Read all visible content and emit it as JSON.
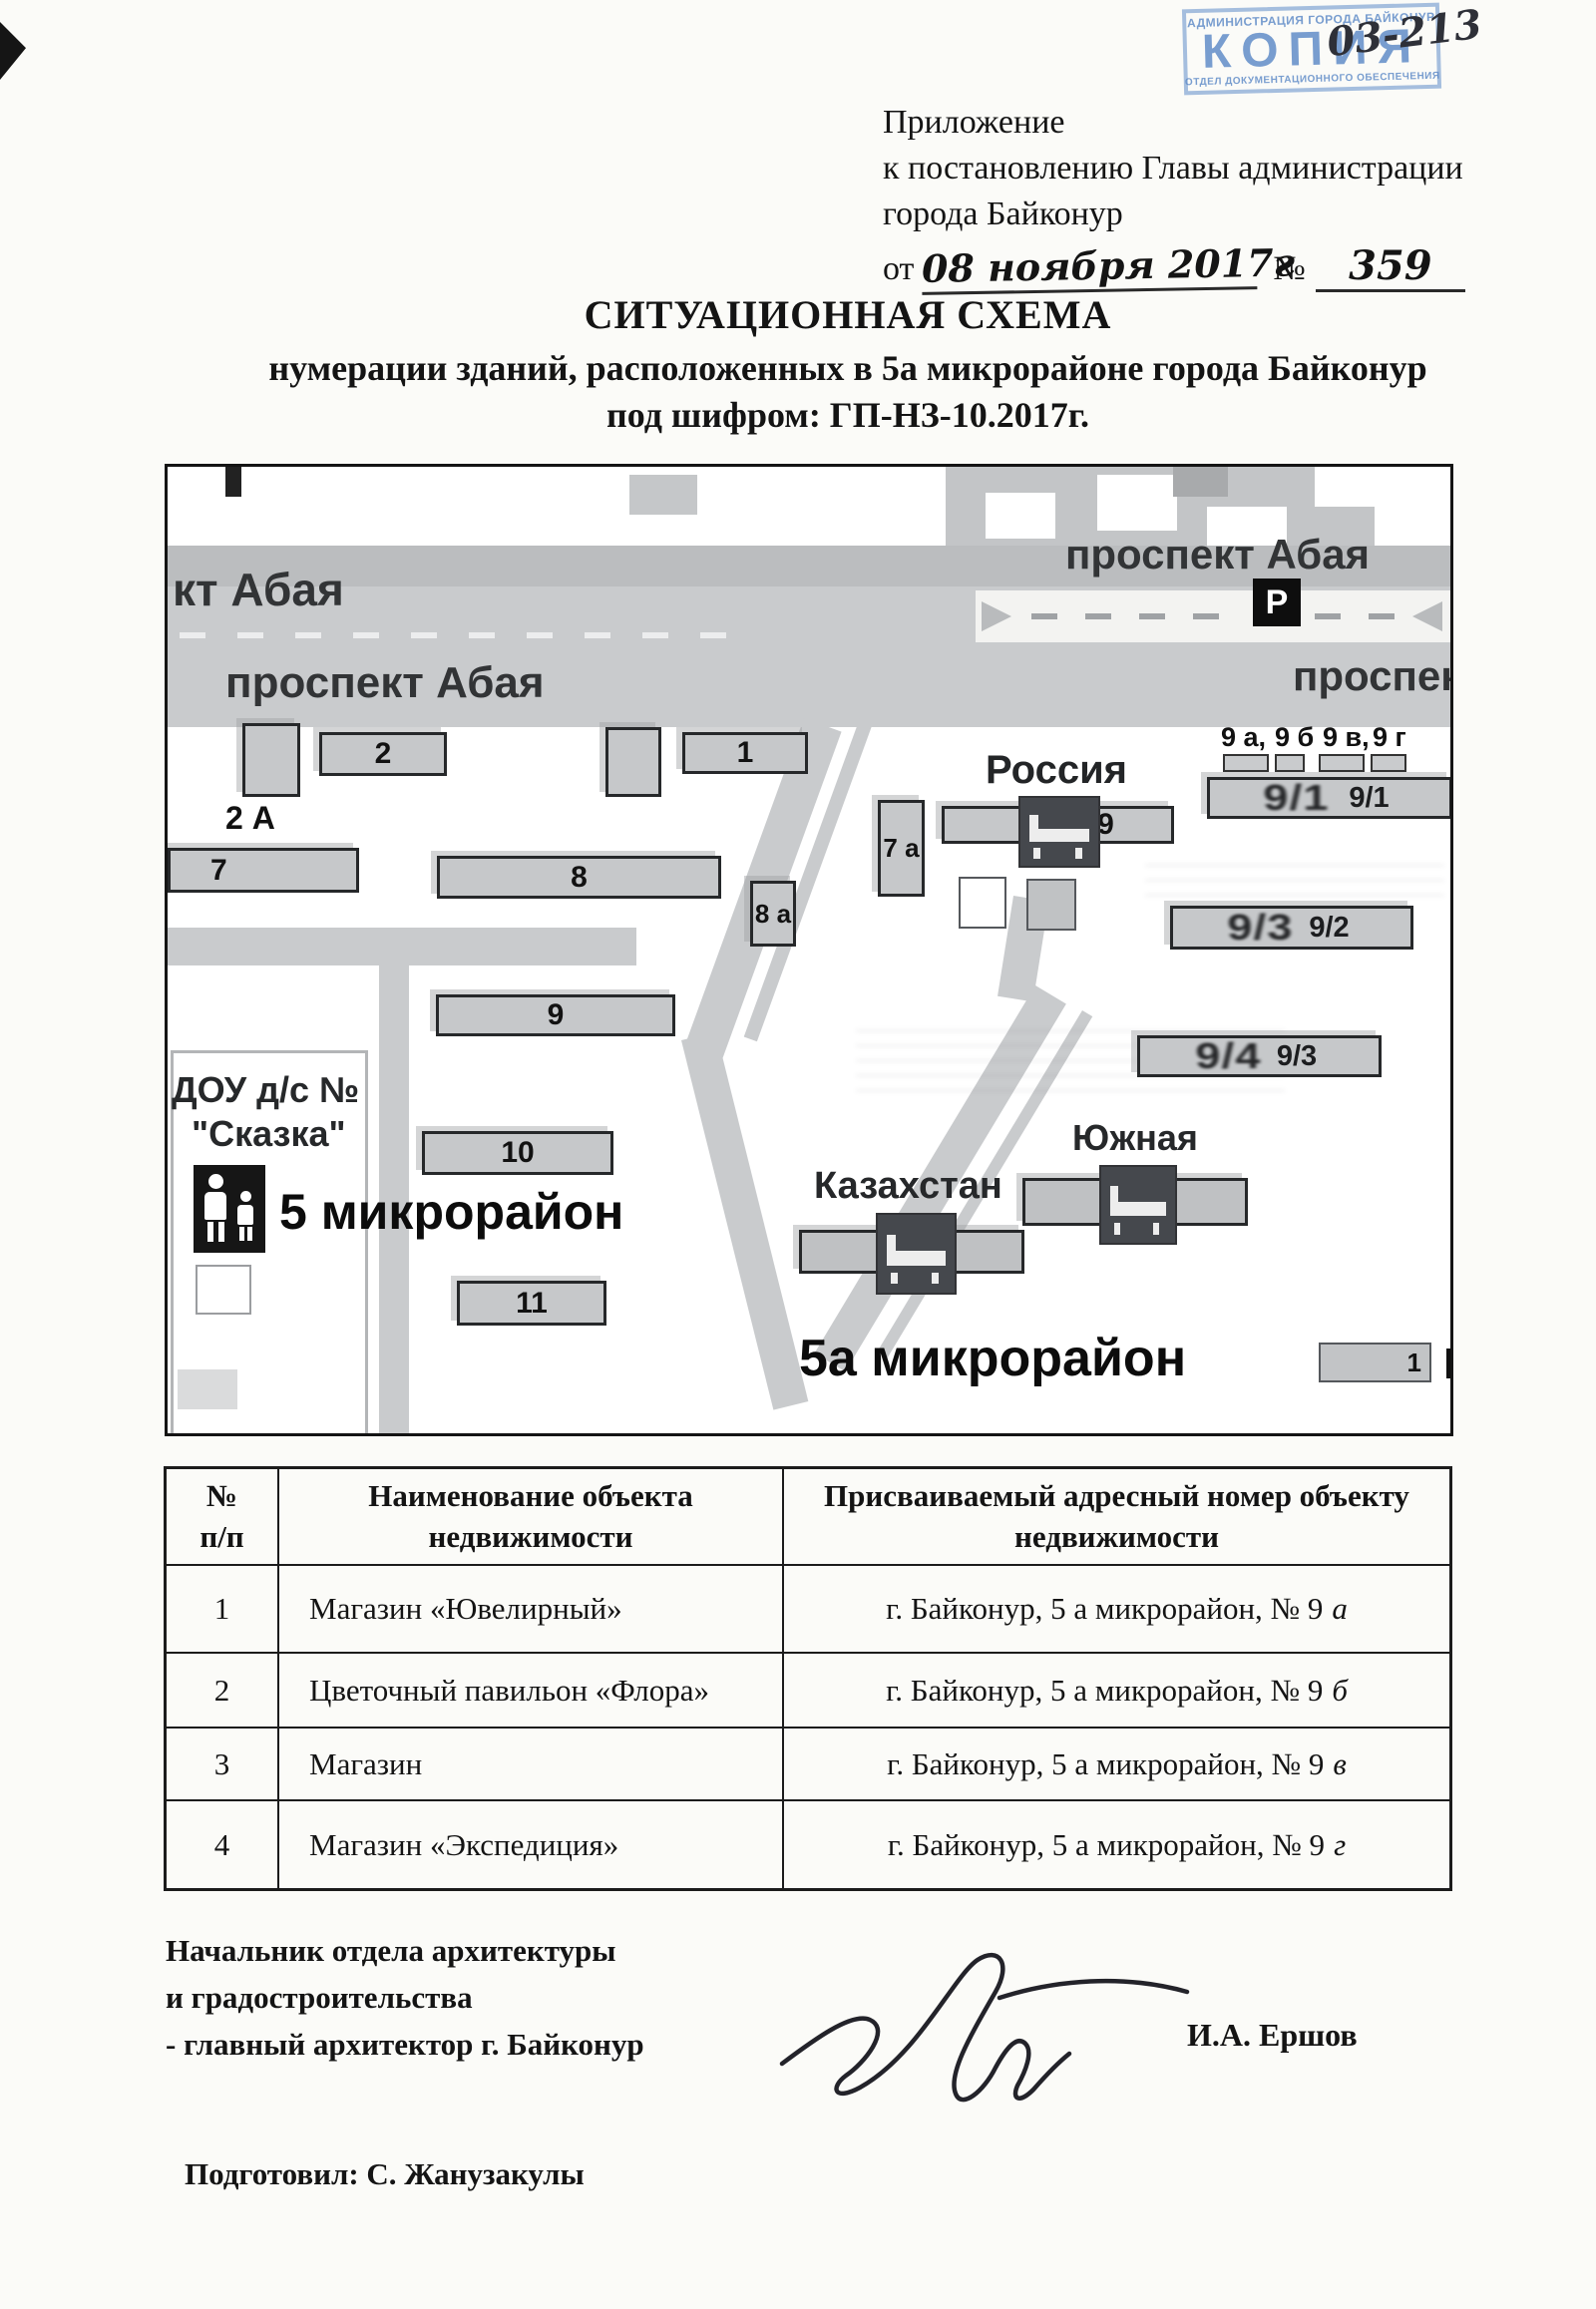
{
  "stamp": {
    "line_top": "АДМИНИСТРАЦИЯ ГОРОДА БАЙКОНУР",
    "word": "КОПИЯ",
    "line_bottom": "ОТДЕЛ ДОКУМЕНТАЦИОННОГО ОБЕСПЕЧЕНИЯ",
    "handwritten_no": "03-213"
  },
  "header": {
    "line1": "Приложение",
    "line2": "к постановлению Главы администрации",
    "line3": "города Байконур",
    "from_label": "от",
    "date_value": "08 ноября 2017г",
    "no_label": "№",
    "no_value": "359"
  },
  "title": {
    "line1": "СИТУАЦИОННАЯ СХЕМА",
    "line2": "нумерации зданий, расположенных в 5а микрорайоне города Байконур",
    "line3": "под шифром: ГП-НЗ-10.2017г."
  },
  "map": {
    "street_abaya_clipped": "кт Абая",
    "street_abaya_left": "проспект Абая",
    "street_abaya_right": "проспект Абая",
    "street_abaya_right2": "проспект А",
    "parking": "Р",
    "district_5": "5 микрорайон",
    "district_5a": "5а микрорайон",
    "rossiya": "Россия",
    "kazakhstan": "Казахстан",
    "yuzhnaya": "Южная",
    "dou_line1": "ДОУ д/с №",
    "dou_line2": "\"Сказка\"",
    "buildings": {
      "b2a": "2 А",
      "b2": "2",
      "b1": "1",
      "b7": "7",
      "b8": "8",
      "b8a": "8 а",
      "b7a": "7 а",
      "b9_rossiya": "9",
      "b9_1_overprint": "9/1",
      "b9_1": "9/1",
      "b9_2_overprint": "9/3",
      "b9_2": "9/2",
      "b9_3_overprint": "9/4",
      "b9_3": "9/3",
      "b9": "9",
      "b10": "10",
      "b11": "11",
      "b17": "1"
    },
    "kiosks": {
      "k1": "9 а,",
      "k2": "9 б",
      "k3": "9 в,",
      "k4": "9 г"
    }
  },
  "table": {
    "col_num": "№ п/п",
    "col_name": "Наименование объекта недвижимости",
    "col_addr": "Присваиваемый адресный номер объекту недвижимости",
    "rows": [
      {
        "num": "1",
        "name": "Магазин «Ювелирный»",
        "addr": "г. Байконур, 5 а микрорайон, № 9",
        "letter": "а"
      },
      {
        "num": "2",
        "name": "Цветочный павильон «Флора»",
        "addr": "г. Байконур, 5 а микрорайон, № 9",
        "letter": "б"
      },
      {
        "num": "3",
        "name": "Магазин",
        "addr": "г. Байконур, 5 а микрорайон, № 9",
        "letter": "в"
      },
      {
        "num": "4",
        "name": "Магазин «Экспедиция»",
        "addr": "г. Байконур, 5 а микрорайон, № 9",
        "letter": "г"
      }
    ]
  },
  "signature": {
    "line1": "Начальник отдела архитектуры",
    "line2": "и градостроительства",
    "line3": "- главный архитектор г. Байконур",
    "name": "И.А. Ершов"
  },
  "footer": {
    "prepared": "Подготовил:  С. Жанузакулы"
  }
}
